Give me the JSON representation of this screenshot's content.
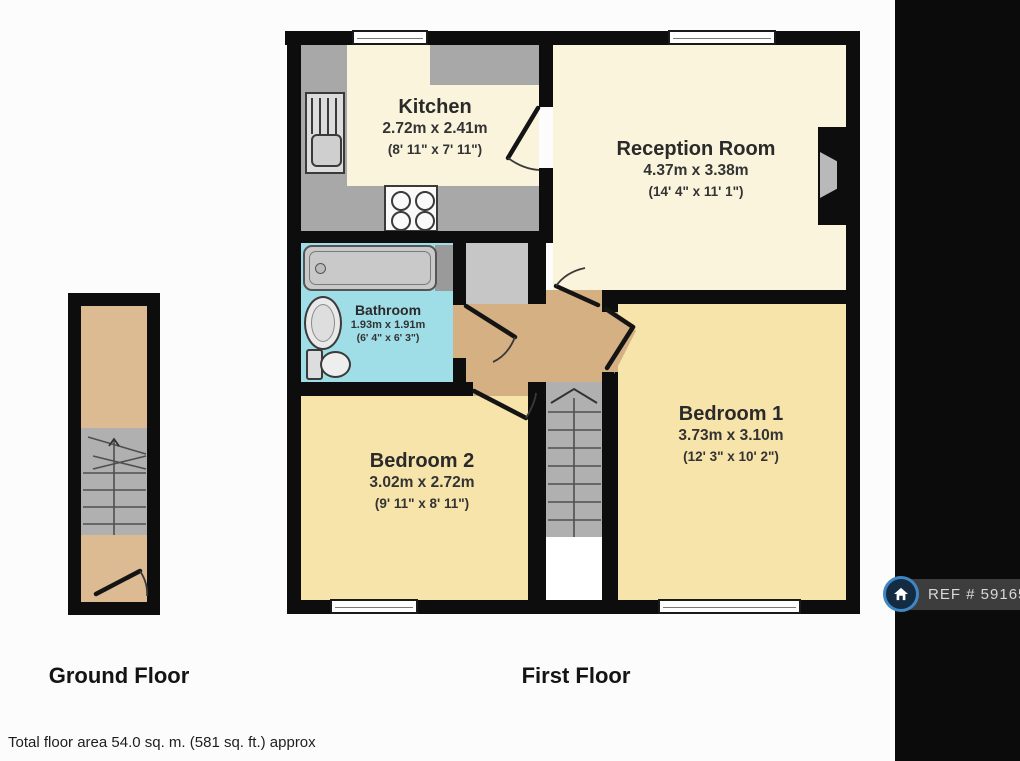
{
  "rooms": {
    "kitchen": {
      "name": "Kitchen",
      "dims_m": "2.72m x 2.41m",
      "dims_ft": "(8' 11\" x 7' 11\")"
    },
    "reception": {
      "name": "Reception Room",
      "dims_m": "4.37m x 3.38m",
      "dims_ft": "(14' 4\" x 11' 1\")"
    },
    "bathroom": {
      "name": "Bathroom",
      "dims_m": "1.93m x 1.91m",
      "dims_ft": "(6' 4\" x 6' 3\")"
    },
    "bedroom1": {
      "name": "Bedroom 1",
      "dims_m": "3.73m x 3.10m",
      "dims_ft": "(12' 3\" x 10' 2\")"
    },
    "bedroom2": {
      "name": "Bedroom 2",
      "dims_m": "3.02m x 2.72m",
      "dims_ft": "(9' 11\" x 8' 11\")"
    }
  },
  "floors": {
    "ground": {
      "label": "Ground Floor"
    },
    "first": {
      "label": "First Floor"
    }
  },
  "footer": {
    "total_area": "Total floor area 54.0 sq. m. (581 sq. ft.) approx"
  },
  "ref_badge": {
    "text": "REF # 591650"
  },
  "colors": {
    "wall": "#0d0d0d",
    "cream": "#faf4dc",
    "yellow": "#f7e4ab",
    "blue": "#9fdde7",
    "tan": "#d4b083",
    "halltan": "#dcba92",
    "stairgray": "#b0b0b0",
    "countergray": "#a8a8a8",
    "cupboard": "#c6c6c6",
    "sidebar": "#0b0b0b",
    "refbar": "#3d3d3d",
    "logoblue": "#3f86c6"
  }
}
